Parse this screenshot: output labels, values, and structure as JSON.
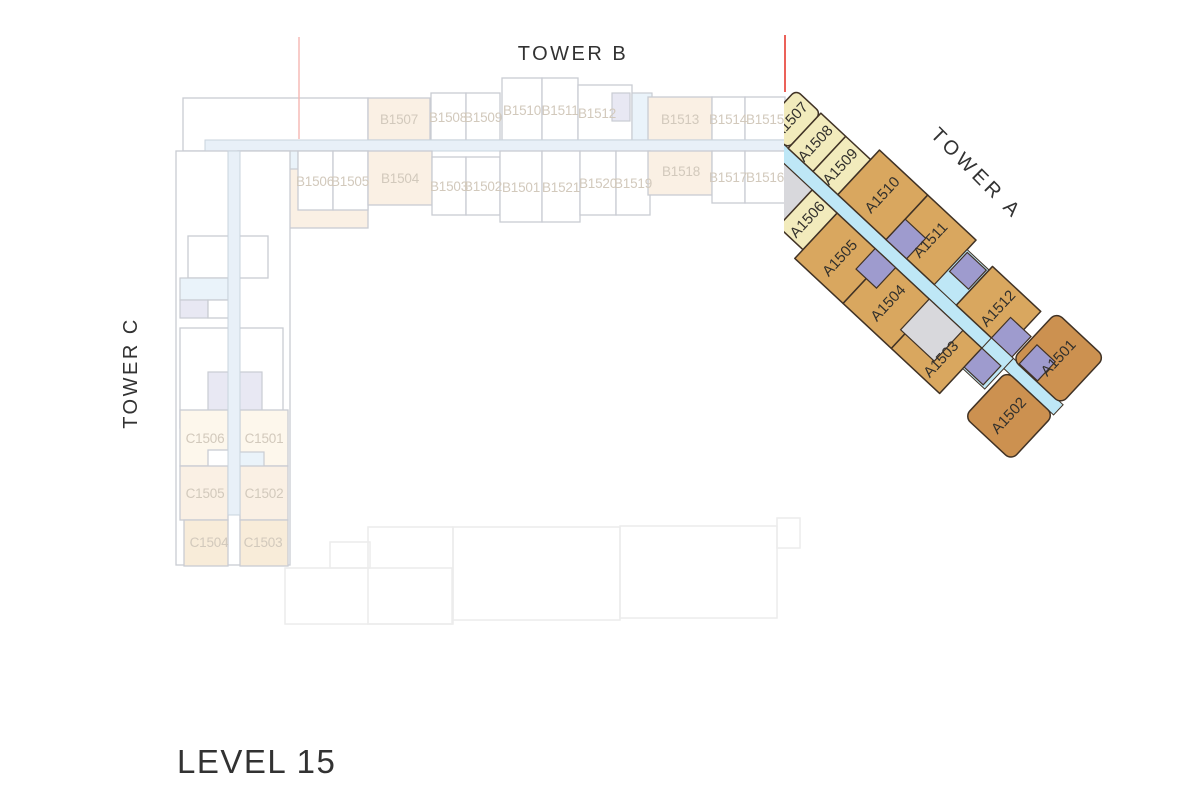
{
  "level": {
    "label": "LEVEL 15"
  },
  "towers": {
    "a": {
      "label": "TOWER A",
      "units": [
        {
          "id": "A1501",
          "color": "unit-caramel"
        },
        {
          "id": "A1502",
          "color": "unit-caramel"
        },
        {
          "id": "A1503",
          "color": "unit-tan"
        },
        {
          "id": "A1504",
          "color": "unit-tan"
        },
        {
          "id": "A1505",
          "color": "unit-tan"
        },
        {
          "id": "A1506",
          "color": "unit-yellow"
        },
        {
          "id": "A1507",
          "color": "unit-yellow"
        },
        {
          "id": "A1508",
          "color": "unit-yellow"
        },
        {
          "id": "A1509",
          "color": "unit-yellow"
        },
        {
          "id": "A1510",
          "color": "unit-tan"
        },
        {
          "id": "A1511",
          "color": "unit-tan"
        },
        {
          "id": "A1512",
          "color": "unit-tan"
        }
      ]
    },
    "b": {
      "label": "TOWER B",
      "units": [
        {
          "id": "B1501"
        },
        {
          "id": "B1502"
        },
        {
          "id": "B1503"
        },
        {
          "id": "B1504"
        },
        {
          "id": "B1505"
        },
        {
          "id": "B1506"
        },
        {
          "id": "B1507"
        },
        {
          "id": "B1508"
        },
        {
          "id": "B1509"
        },
        {
          "id": "B1510"
        },
        {
          "id": "B1511"
        },
        {
          "id": "B1512"
        },
        {
          "id": "B1513"
        },
        {
          "id": "B1514"
        },
        {
          "id": "B1515"
        },
        {
          "id": "B1516"
        },
        {
          "id": "B1517"
        },
        {
          "id": "B1518"
        },
        {
          "id": "B1519"
        },
        {
          "id": "B1520"
        },
        {
          "id": "B1521"
        }
      ]
    },
    "c": {
      "label": "TOWER C",
      "units": [
        {
          "id": "C1501"
        },
        {
          "id": "C1502"
        },
        {
          "id": "C1503"
        },
        {
          "id": "C1504"
        },
        {
          "id": "C1505"
        },
        {
          "id": "C1506"
        },
        {
          "id": "C1507"
        }
      ]
    }
  },
  "colors": {
    "unit_yellow": "#f2ebbc",
    "unit_tan": "#d9a75f",
    "unit_caramel": "#cc9150",
    "unit_line": "#403225",
    "corridor_blue": "#bee7f6",
    "elevator_purple": "#9e9bce",
    "service_gray": "#d8d8dc",
    "ghost_line": "#c9ccd3",
    "ghost_cream": "#faf0e4",
    "ghost_lavender": "#e8e8f3",
    "ghost_blue": "#eaf3fa",
    "ghost_corridor": "#e8f0f8",
    "ghost_corridor_line": "#c9d3dd",
    "ghost_label": "#d2c9bc",
    "podium_line": "#ececec",
    "section_line_red": "#e6392f",
    "section_line_ghost": "#f4b6b2",
    "text_dark": "#323232"
  }
}
